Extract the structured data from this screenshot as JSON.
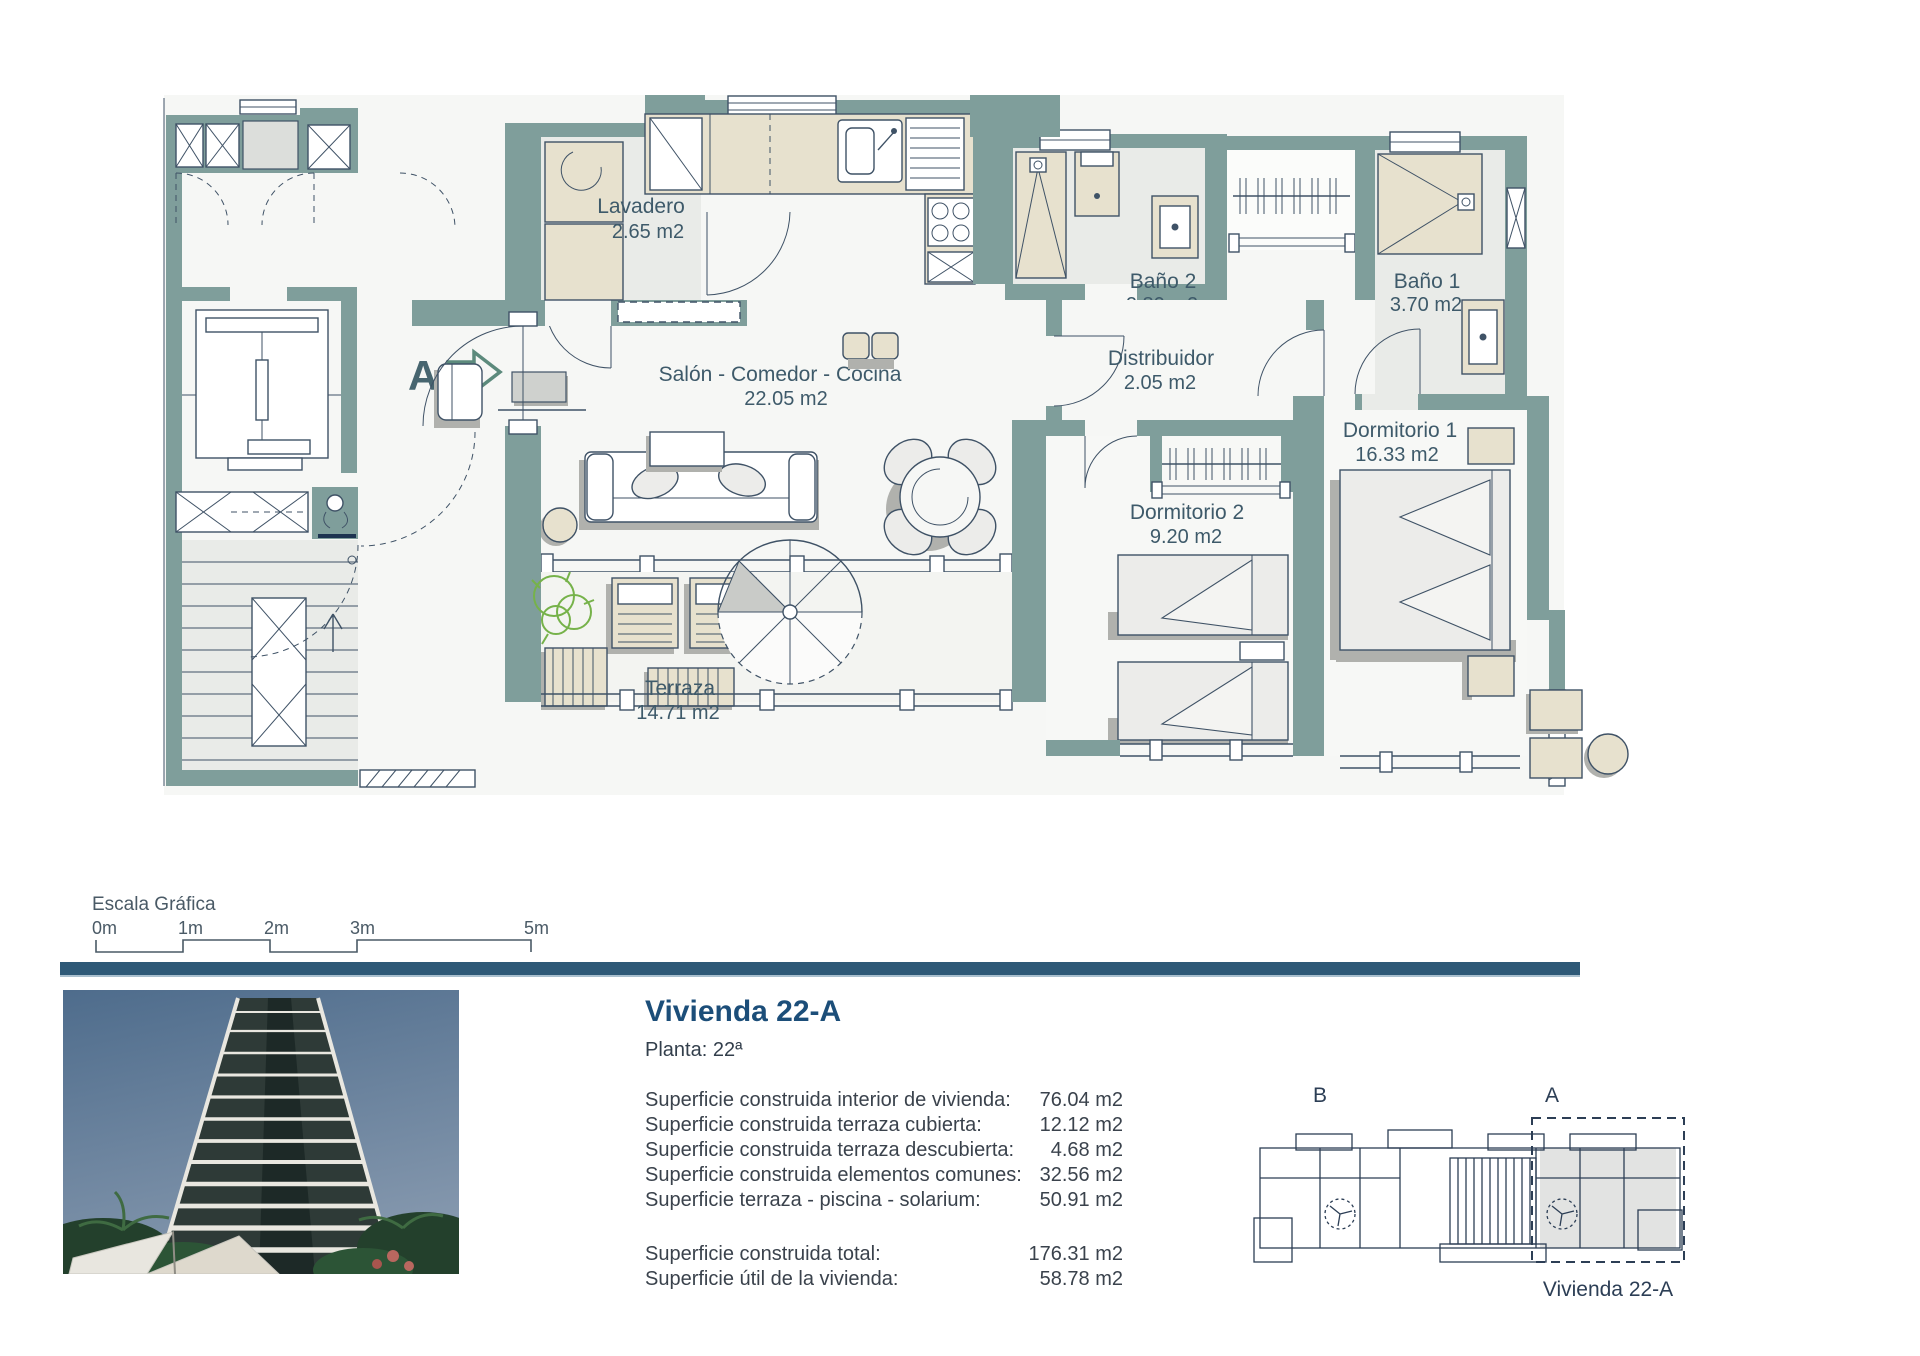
{
  "plan": {
    "section_label": "A",
    "rooms": [
      {
        "name": "Lavadero",
        "area": "2.65 m2"
      },
      {
        "name": "Salón - Comedor - Cocina",
        "area": "22.05 m2"
      },
      {
        "name": "Baño 2",
        "area": "2.80 m2"
      },
      {
        "name": "Distribuidor",
        "area": "2.05 m2"
      },
      {
        "name": "Baño 1",
        "area": "3.70 m2"
      },
      {
        "name": "Dormitorio 1",
        "area": "16.33 m2"
      },
      {
        "name": "Dormitorio 2",
        "area": "9.20 m2"
      },
      {
        "name": "Terraza",
        "area": "14.71 m2"
      }
    ],
    "colors": {
      "wall": "#7f9e9b",
      "line": "#3f5266",
      "label": "#3e5a6a",
      "furniture": "#e7e1ce"
    }
  },
  "scale": {
    "title": "Escala Gráfica",
    "ticks": [
      "0m",
      "1m",
      "2m",
      "3m",
      "5m"
    ]
  },
  "info": {
    "title": "Vivienda 22-A",
    "floor": "Planta: 22ª",
    "rows": [
      {
        "label": "Superficie construida interior de vivienda:",
        "value": "76.04 m2"
      },
      {
        "label": "Superficie construida terraza cubierta:",
        "value": "12.12 m2"
      },
      {
        "label": "Superficie construida terraza descubierta:",
        "value": "4.68 m2"
      },
      {
        "label": "Superficie construida elementos comunes:",
        "value": "32.56 m2"
      },
      {
        "label": "Superficie terraza - piscina - solarium:",
        "value": "50.91 m2"
      }
    ],
    "totals": [
      {
        "label": "Superficie construida total:",
        "value": "176.31 m2"
      },
      {
        "label": "Superficie útil de la vivienda:",
        "value": "58.78 m2"
      }
    ],
    "title_color": "#1c4e79",
    "divider_color": "#2e5977"
  },
  "keyplan": {
    "label_b": "B",
    "label_a": "A",
    "caption": "Vivienda 22-A"
  }
}
